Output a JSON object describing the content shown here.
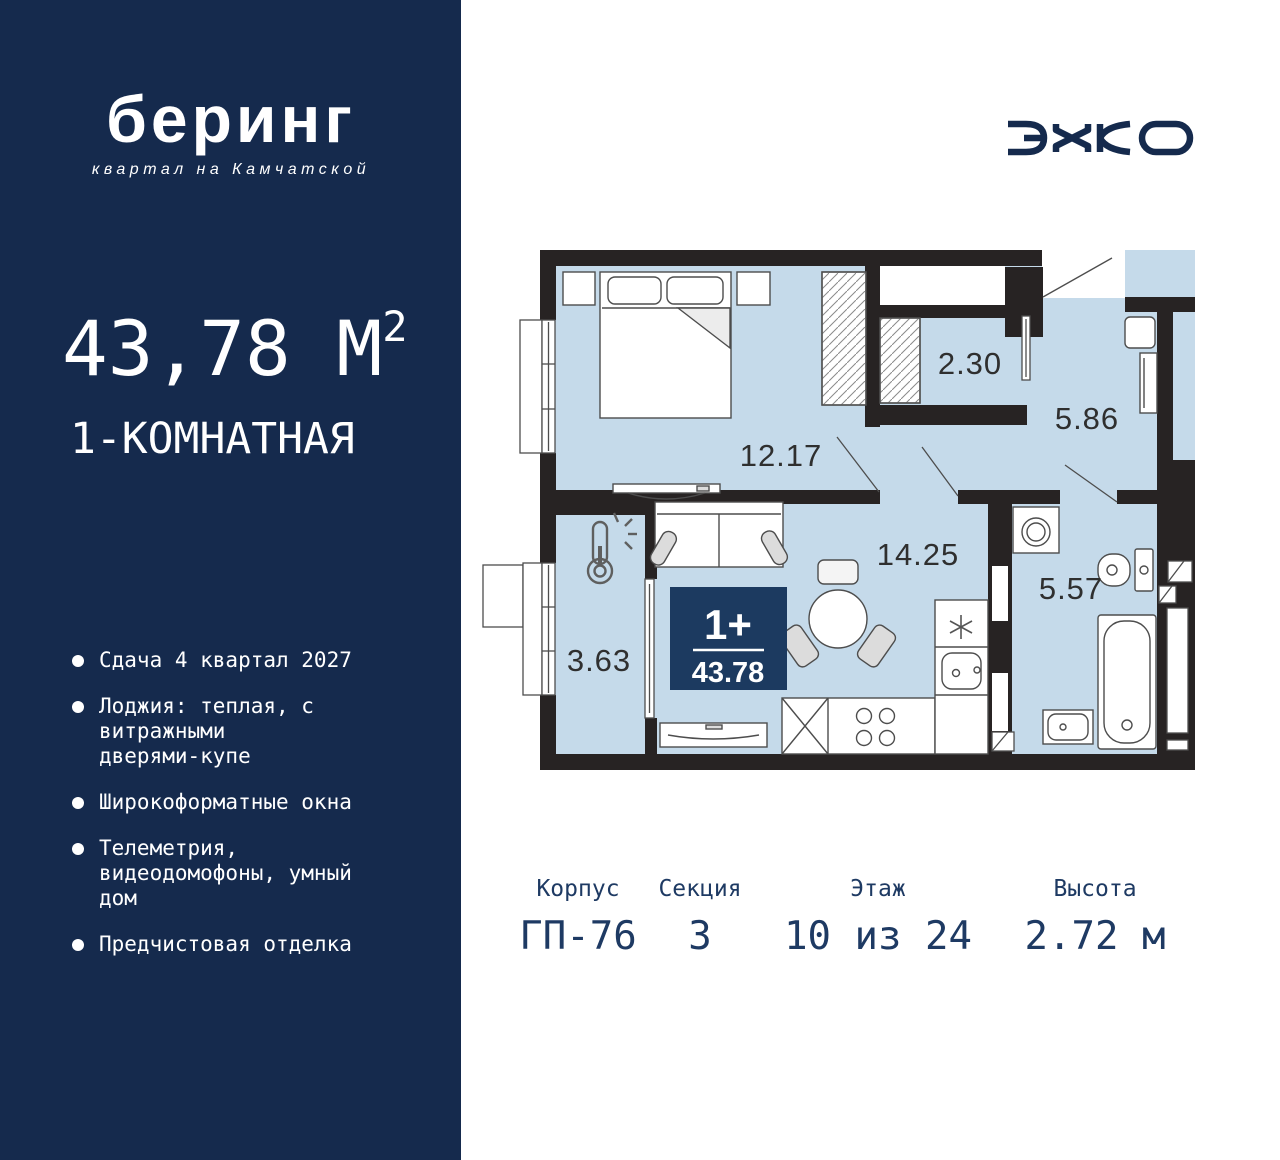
{
  "colors": {
    "sidebar_navy": "#152A4D",
    "badge_navy": "#1C3A60",
    "room_fill": "#C5DAEA",
    "wall_black": "#272323",
    "info_navy": "#1E3A63"
  },
  "sidebar": {
    "logo_title": "беринг",
    "logo_subtitle": "квартал на Камчатской",
    "area_value": "43,78",
    "area_unit": " М",
    "area_sup": "2",
    "apartment_type": "1-КОМНАТНАЯ",
    "features": [
      "Сдача 4 квартал 2027",
      "Лоджия: теплая, с\nвитражными\nдверями-купе",
      "Широкоформатные окна",
      "Телеметрия,\nвидеодомофоны, умный\nдом",
      "Предчистовая отделка"
    ]
  },
  "developer": {
    "name": "ЭНКО"
  },
  "plan": {
    "rooms": {
      "bedroom": "12.17",
      "wardrobe": "2.30",
      "hallway": "5.86",
      "living": "14.25",
      "bathroom": "5.57",
      "loggia": "3.63"
    },
    "badge": {
      "type": "1+",
      "area": "43.78"
    }
  },
  "info": {
    "columns": [
      {
        "label": "Корпус",
        "value": "ГП-76"
      },
      {
        "label": "Секция",
        "value": "3"
      },
      {
        "label": "Этаж",
        "value": "10 из 24"
      },
      {
        "label": "Высота",
        "value": "2.72 м"
      }
    ]
  }
}
